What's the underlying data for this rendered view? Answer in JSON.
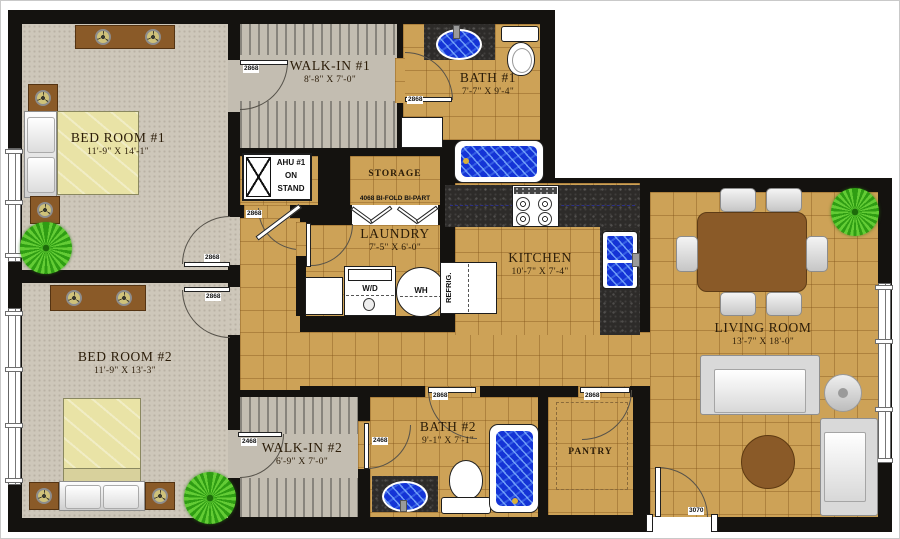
{
  "rooms": {
    "bed1": {
      "name": "BED ROOM #1",
      "dims": "11'-9\" X 14'-1\""
    },
    "bed2": {
      "name": "BED ROOM #2",
      "dims": "11'-9\" X 13'-3\""
    },
    "walkin1": {
      "name": "WALK-IN #1",
      "dims": "8'-8\" X 7'-0\""
    },
    "walkin2": {
      "name": "WALK-IN #2",
      "dims": "6'-9\" X 7'-0\""
    },
    "bath1": {
      "name": "BATH #1",
      "dims": "7'-7\" X 9'-4\""
    },
    "bath2": {
      "name": "BATH #2",
      "dims": "9'-1\" X 7'-1\""
    },
    "laundry": {
      "name": "LAUNDRY",
      "dims": "7'-5\" X 6'-0\""
    },
    "kitchen": {
      "name": "KITCHEN",
      "dims": "10'-7\" X 7'-4\""
    },
    "living": {
      "name": "LIVING ROOM",
      "dims": "13'-7\" X 18'-0\""
    },
    "storage": {
      "name": "STORAGE"
    },
    "pantry": {
      "name": "PANTRY"
    }
  },
  "equipment": {
    "ahu_label": "AHU #1\nON\nSTAND"
  },
  "appliances": {
    "washer_dryer": "W/D",
    "water_heater": "WH",
    "refrigerator": "REFRIG."
  },
  "doors": {
    "walkin1": "2868",
    "bath1": "2868",
    "ahu": "2868",
    "bed1": "2868",
    "bed2": "2868",
    "walkin2": "2468",
    "bath2_inner": "2468",
    "bath2_hall": "2868",
    "pantry": "2868",
    "entry": "3070",
    "storage_bifold": "4068 BI-FOLD BI-PART"
  },
  "colors": {
    "wall": "#14120f",
    "tile": "#cda257",
    "carpet": "#cec7ba",
    "closet_carpet": "#c3bdb1",
    "granite": "#2d2b29",
    "water_blue": "#1434d6",
    "wood_brown": "#8a5a28",
    "bed_spread": "#e9e3a6",
    "plant_green": "#2f9d13",
    "chair_gray": "#d9d9d9"
  }
}
